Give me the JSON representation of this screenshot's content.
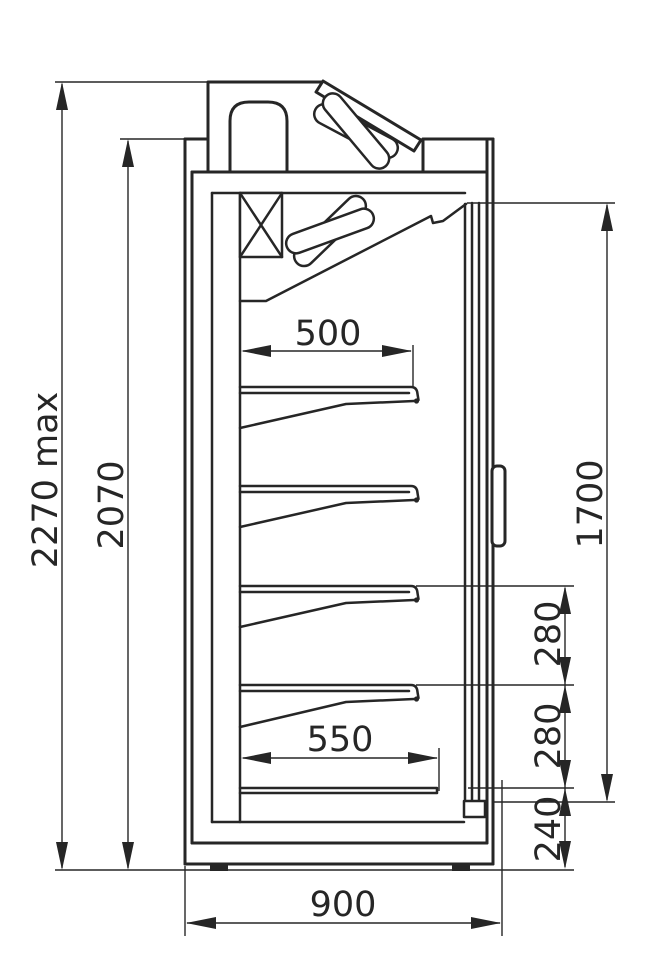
{
  "page": {
    "background": "#ffffff",
    "line_color": "#262626"
  },
  "drawing": {
    "type": "technical-dimension-drawing",
    "subject": "refrigerated display cabinet — side section view",
    "units": "mm",
    "labels": {
      "overall_height": "2270 max",
      "body_height": "2070",
      "shelf_depth": "500",
      "door_height": "1700",
      "shelf_pitch_upper": "280",
      "shelf_pitch_lower": "280",
      "base_height": "240",
      "bottom_shelf_depth": "550",
      "overall_depth": "900"
    },
    "dimensions_mm": {
      "overall_height_max": 2270,
      "body_height": 2070,
      "shelf_depth": 500,
      "door_height": 1700,
      "shelf_pitch": 280,
      "base_height": 240,
      "bottom_shelf_depth": 550,
      "overall_depth": 900
    },
    "shelf_count": 4
  }
}
